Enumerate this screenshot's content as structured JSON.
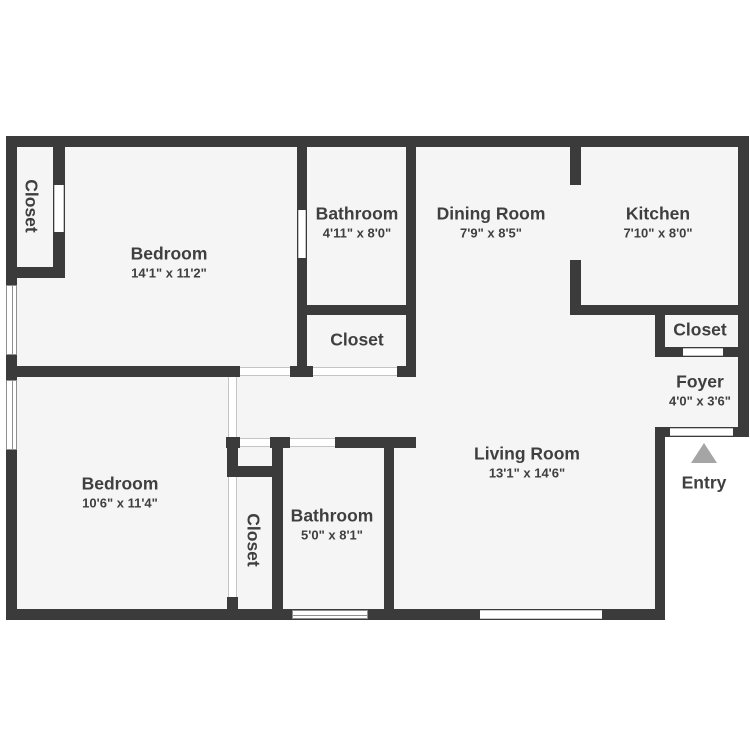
{
  "plan": {
    "title": "Two bedroom apartment floor plan",
    "colors": {
      "wall": "#3b3b3b",
      "floor": "#f5f5f6",
      "background": "#ffffff",
      "text": "#3f3f3f",
      "entry_arrow": "#a5a5a5"
    },
    "entry_arrow_icon": "triangle-up"
  },
  "rooms": {
    "closet_top_left": {
      "name": "Closet"
    },
    "bedroom_top": {
      "name": "Bedroom",
      "dims": "14'1\" x 11'2\""
    },
    "bathroom_top": {
      "name": "Bathroom",
      "dims": "4'11\" x 8'0\""
    },
    "dining_room": {
      "name": "Dining Room",
      "dims": "7'9\" x 8'5\""
    },
    "kitchen": {
      "name": "Kitchen",
      "dims": "7'10\" x 8'0\""
    },
    "closet_mid": {
      "name": "Closet"
    },
    "closet_kitchen": {
      "name": "Closet"
    },
    "foyer": {
      "name": "Foyer",
      "dims": "4'0\" x 3'6\""
    },
    "living_room": {
      "name": "Living Room",
      "dims": "13'1\" x 14'6\""
    },
    "bedroom_bottom": {
      "name": "Bedroom",
      "dims": "10'6\" x 11'4\""
    },
    "bathroom_bottom": {
      "name": "Bathroom",
      "dims": "5'0\" x 8'1\""
    },
    "closet_bottom": {
      "name": "Closet"
    },
    "entry": {
      "name": "Entry"
    }
  }
}
